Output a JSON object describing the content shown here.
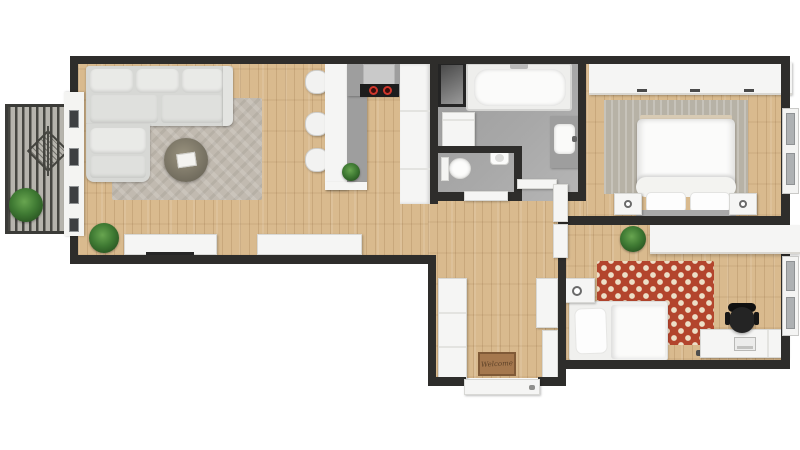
{
  "scene": {
    "description": "3D rendered top-down floor plan of a two-bedroom apartment with open living-kitchen area, bathroom, separate WC, hallway and balcony",
    "background": "#ffffff"
  },
  "labels": {
    "doormat": "Welcome"
  },
  "palette": {
    "wall": "#2e2d2b",
    "wood": "#d9ba8e",
    "tile": "#a8a8a8",
    "deck": "#b6b4ad",
    "white": "#f5f5f4",
    "counter": "#9e9e9e",
    "sofa": "#d7d8d5",
    "sofa_light": "#e9eae7",
    "rug_living": "#c1bab0",
    "rug_master": "#b7b2a6",
    "rug_red": "#b3452d",
    "rug_dot": "#ecdfc7",
    "green": "#3f7a33",
    "green_dark": "#2c5a24",
    "cooktop": "#1d1d1d",
    "burner": "#d1372c",
    "chair": "#242424",
    "mat": "#a5784e",
    "mat_text": "#5e4228",
    "glass": "#aeb1b3"
  },
  "rooms": [
    {
      "id": "living-room",
      "furniture": [
        "corner-sofa",
        "area-rug",
        "coffee-table",
        "tv-sideboard",
        "sideboard",
        "floor-plant"
      ]
    },
    {
      "id": "kitchen",
      "furniture": [
        "island",
        "bar-stools",
        "counter",
        "range-hood",
        "cooktop",
        "tall-cabinets",
        "counter-plant"
      ]
    },
    {
      "id": "balcony",
      "furniture": [
        "deck",
        "railing",
        "drying-rack",
        "potted-plant",
        "glazed-door"
      ]
    },
    {
      "id": "bathroom",
      "furniture": [
        "bathtub",
        "shower-cabinet",
        "washing-machine",
        "vanity-sink"
      ]
    },
    {
      "id": "wc",
      "furniture": [
        "toilet",
        "hand-basin"
      ]
    },
    {
      "id": "hallway",
      "furniture": [
        "tall-wardrobe",
        "cabinet",
        "cabinet",
        "welcome-doormat",
        "entrance-door"
      ]
    },
    {
      "id": "master-bedroom",
      "furniture": [
        "double-bed",
        "nightstand-left",
        "nightstand-right",
        "wardrobe",
        "area-rug",
        "casement-window"
      ]
    },
    {
      "id": "second-bedroom",
      "furniture": [
        "single-bed",
        "desk",
        "office-chair",
        "wardrobe",
        "polka-dot-rug",
        "nightstand",
        "plant",
        "casement-window"
      ]
    }
  ]
}
